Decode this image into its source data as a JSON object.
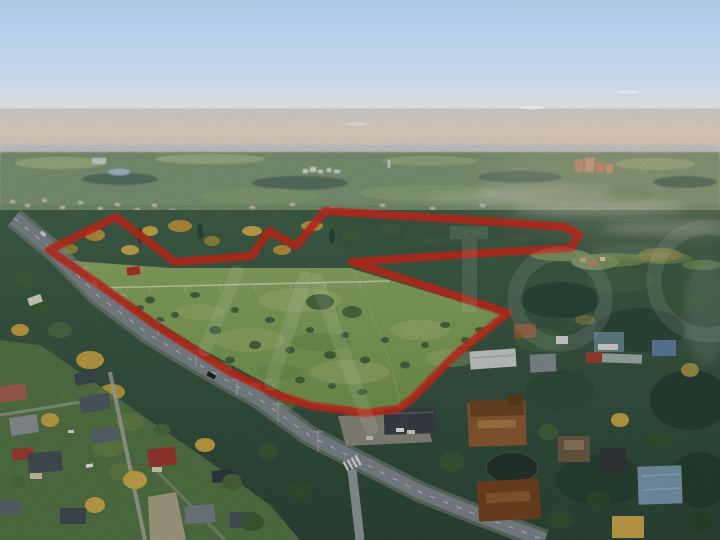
{
  "image": {
    "kind": "aerial-drone-photograph",
    "description": "Sunset aerial photo of a rural land plot outlined in red (classifieds listing photo with translucent watermark)",
    "width_px": 720,
    "height_px": 540
  },
  "palette": {
    "boundary_red": "#cb2c1d",
    "sky_top": "#abc9e6",
    "sky_mid": "#cfdcea",
    "sky_horizon_warm": "#f0dcc8",
    "haze_band": "#c9ced2",
    "distant_field": "#93ab79",
    "distant_forest": "#56725e",
    "near_forest": "#3c5a45",
    "meadow_light": "#8aa863",
    "meadow_dark": "#74954e",
    "autumn_tree": "#c2a246",
    "road_asphalt": "#7e868d",
    "village_grass": "#587947",
    "pond_water": "#26352e",
    "town_salmon": "#cb8a6d",
    "lake_blue": "#9fb9c6"
  },
  "boundary": {
    "label": "land-plot-red-outline",
    "stroke_width": 8,
    "opacity": 0.88,
    "points_str": "49,250 116,217 175,262 252,256 269,231 296,246 325,211 470,220 565,227 579,235 571,248 470,254 352,262 508,313 455,355 412,399 398,409 365,413 313,406 280,396 230,372 163,330 97,283"
  },
  "watermark": {
    "label": "avito-style-translucent-watermark",
    "color": "#ffffff",
    "opacity": 0.11
  },
  "scene": {
    "regions": [
      "sunset-sky",
      "horizon-haze",
      "distant-town-and-fields",
      "small-lake",
      "mid-forest-belt",
      "fog-wisps",
      "main-meadow-plot",
      "inner-forest-strip",
      "right-forest",
      "main-road",
      "side-road",
      "crosswalk",
      "bottom-left-village",
      "bottom-right-village",
      "large-wooden-house",
      "garden-pond",
      "gas-pipeline",
      "power-poles",
      "cars"
    ]
  }
}
